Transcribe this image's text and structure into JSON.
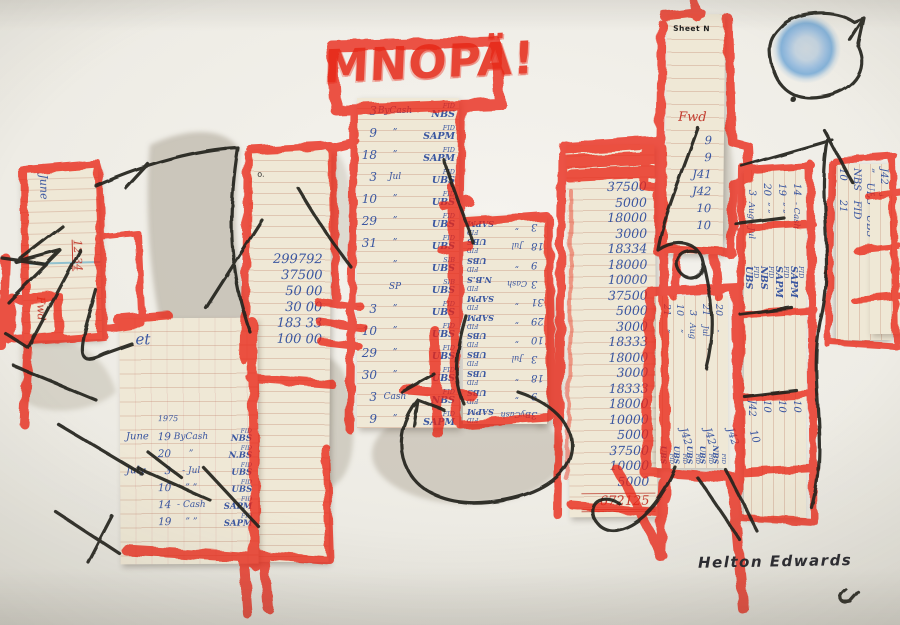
{
  "artwork": {
    "title_scrawl": "MNOPÄ!",
    "signature": "Helton Edwards",
    "colors": {
      "crayon_red": "#ea2716",
      "ink_black": "#20201f",
      "pen_blue": "#3a56a0",
      "pen_red": "#c23b2e",
      "paper": "#efe8d6",
      "background": "#eeece5",
      "wash_grey": "#a69e8d",
      "sun_blue": "#85b2d8"
    }
  },
  "strips": {
    "left": {
      "month": "June",
      "amount": "12 34",
      "foot": "Fwd"
    },
    "blank": {
      "mark": "o."
    },
    "ledger_numbers": {
      "values": [
        "299792",
        "37500",
        "50 00",
        "30 00",
        "183 33",
        "100 00"
      ]
    },
    "central": {
      "entries": [
        {
          "day": "3",
          "label": "ByCash",
          "tag": "FID",
          "org": "NBS"
        },
        {
          "day": "9",
          "label": "”",
          "tag": "FID",
          "org": "SAPM"
        },
        {
          "day": "18",
          "label": "”",
          "tag": "FID",
          "org": "SAPM"
        },
        {
          "day": "3",
          "label": "Jul",
          "tag": "FID",
          "org": "UBS"
        },
        {
          "day": "10",
          "label": "”",
          "tag": "FID",
          "org": "UBS"
        },
        {
          "day": "29",
          "label": "”",
          "tag": "FID",
          "org": "UBS"
        },
        {
          "day": "31",
          "label": "”",
          "tag": "FID",
          "org": "UBS"
        },
        {
          "day": "",
          "label": "”",
          "tag": "SIB",
          "org": "UBS"
        },
        {
          "day": "",
          "label": "SP",
          "tag": "SIB",
          "org": "UBS"
        },
        {
          "day": "3",
          "label": "”",
          "tag": "FID",
          "org": "UBS"
        },
        {
          "day": "10",
          "label": "”",
          "tag": "FID",
          "org": "UBS"
        },
        {
          "day": "29",
          "label": "”",
          "tag": "FID",
          "org": "UBS"
        },
        {
          "day": "30",
          "label": "”",
          "tag": "FID",
          "org": "UBS"
        },
        {
          "day": "3",
          "label": "Cash",
          "tag": "FID",
          "org": "NBS"
        },
        {
          "day": "9",
          "label": "”",
          "tag": "FID",
          "org": "SAPM"
        }
      ]
    },
    "inverted": {
      "entries": [
        {
          "day": "3",
          "label": "ByCash",
          "tag": "FID",
          "org": "SAPM"
        },
        {
          "day": "9",
          "label": "”",
          "tag": "FID",
          "org": "UBS"
        },
        {
          "day": "18",
          "label": "”",
          "tag": "FID",
          "org": "UBS"
        },
        {
          "day": "3",
          "label": "Jul",
          "tag": "FID",
          "org": "UBS"
        },
        {
          "day": "10",
          "label": "”",
          "tag": "FID",
          "org": "UBS"
        },
        {
          "day": "29",
          "label": "”",
          "tag": "FID",
          "org": "SAPM"
        },
        {
          "day": "31",
          "label": "”",
          "tag": "FID",
          "org": "SAPM"
        },
        {
          "day": "3",
          "label": "Cash",
          "tag": "FID",
          "org": "N.B.S"
        },
        {
          "day": "9",
          "label": "”",
          "tag": "FID",
          "org": "UBS"
        },
        {
          "day": "18",
          "label": "Jul",
          "tag": "FID",
          "org": "UBS"
        },
        {
          "day": "3",
          "label": "”",
          "tag": "FID",
          "org": "SAPM"
        }
      ]
    },
    "tall": {
      "values": [
        "37500",
        "5000",
        "18000",
        "3000",
        "18334",
        "18000",
        "10000",
        "37500",
        "5000",
        "3000",
        "18333",
        "18000",
        "3000",
        "18333",
        "18000",
        "10000",
        "5000",
        "37500",
        "10000",
        "5000"
      ],
      "total": "672125"
    },
    "tower": {
      "header": "Sheet N",
      "note": "Fwd",
      "values": [
        "9",
        "9",
        "J41",
        "J42",
        "10",
        "10"
      ]
    },
    "aug": {
      "entries": [
        {
          "day": "20",
          "label": "-",
          "tag": "FID",
          "org": "NBS"
        },
        {
          "day": "21",
          "label": "Jul",
          "tag": "FID",
          "org": "UBS"
        },
        {
          "day": "3",
          "label": "Aug",
          "tag": "FID",
          "org": "UBS"
        },
        {
          "day": "10",
          "label": "”",
          "tag": "FID",
          "org": "UBS"
        },
        {
          "day": "21",
          "label": "”",
          "tag": "FID",
          "org": "UBS"
        }
      ],
      "foot": [
        "J42",
        "J42",
        "J42",
        "10"
      ]
    },
    "right_ledger": {
      "entries": [
        {
          "day": "14",
          "label": "- Cash",
          "tag": "FID",
          "org": "SAPM",
          "amt": "10"
        },
        {
          "day": "19",
          "label": "”  ”",
          "tag": "FID",
          "org": "SAPM",
          "amt": "10"
        },
        {
          "day": "20",
          "label": "”  ”",
          "tag": "FID",
          "org": "NBS",
          "amt": "10"
        },
        {
          "day": "3",
          "label": "Aug - Jul",
          "tag": "FID",
          "org": "UBS",
          "amt": "J42"
        }
      ]
    },
    "far_right": {
      "lines": [
        "J42   J42",
        "”   UBS   UBS",
        "NBS   FID",
        "10      21"
      ]
    },
    "bottom_sheet": {
      "note": "et",
      "year": "1975",
      "entries": [
        {
          "m": "June",
          "day": "19",
          "label": "ByCash",
          "tag": "FID",
          "org": "NBS"
        },
        {
          "m": "",
          "day": "20",
          "label": "”",
          "tag": "FID",
          "org": "N.BS"
        },
        {
          "m": "July",
          "day": "3",
          "label": "- Jul",
          "tag": "FID",
          "org": "UBS"
        },
        {
          "m": "",
          "day": "10",
          "label": "” ”",
          "tag": "FID",
          "org": "UBS"
        },
        {
          "m": "",
          "day": "14",
          "label": "- Cash",
          "tag": "FID",
          "org": "SAPM"
        },
        {
          "m": "",
          "day": "19",
          "label": "” ”",
          "tag": "FID",
          "org": "SAPM"
        }
      ]
    }
  }
}
